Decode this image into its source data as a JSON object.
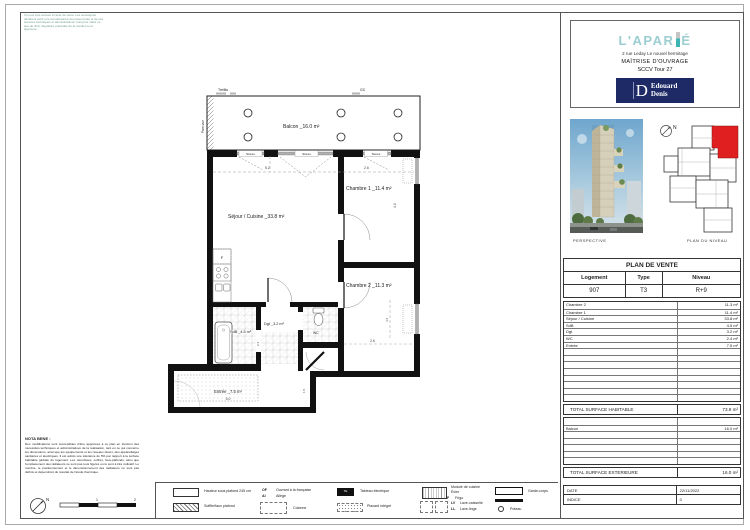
{
  "stamp": {
    "text": "Vu pour être annexé à l'acte de vente. Les soussignés déclarent avoir pris connaissance du présent plan et de ses annexes techniques et administratives. Fait pour valoir ce que de droit. Signature précédée de la mention lu et approuvé."
  },
  "header": {
    "logo_main": "L'APAR",
    "logo_suffix": "É",
    "address": "2 rue Leday Le nouvel hermitage",
    "moa": "MAÎTRISE D'OUVRAGE",
    "sccv": "SCCV Tour 27",
    "builder_initial": "D",
    "builder_line1": "Edouard",
    "builder_line2": "Denis"
  },
  "views": {
    "perspective_label": "PERSPECTIVE",
    "plan_niveau_label": "PLAN DU NIVEAU",
    "north": "N"
  },
  "plan": {
    "treillis": "Treillis",
    "gc": "GC",
    "pare_vue": "Pare-vue",
    "stores": "Stores",
    "balcon": "Balcon _16.0 m²",
    "sejour": "Séjour / Cuisine _33.8 m²",
    "chambre1": "Chambre 1 _11.4 m²",
    "chambre2": "Chambre 2 _11.3 m²",
    "sdb": "SdB _4.5 m²",
    "dgt": "Dgt _3.2 m²",
    "wc": "WC",
    "entree": "Entrée _7.5 m²",
    "f_label": "F",
    "dims": {
      "w_sejour": "5.2",
      "w_ch1": "2.6",
      "h_ch1": "4.0",
      "w_ch2": "2.6",
      "h_ch2": "4.6",
      "w_entree": "5.0",
      "h_entree": "1.5",
      "h_dgt": "2.4"
    }
  },
  "table": {
    "title": "PLAN DE VENTE",
    "col_logement": "Logement",
    "col_type": "Type",
    "col_niveau": "Niveau",
    "logement": "907",
    "type": "T3",
    "niveau": "R+9",
    "rooms": [
      {
        "name": "Chambre 2",
        "area": "11.3 m²"
      },
      {
        "name": "Chambre 1",
        "area": "11.4 m²"
      },
      {
        "name": "Séjour / Cuisine",
        "area": "33.8 m²"
      },
      {
        "name": "SdB",
        "area": "4.5 m²"
      },
      {
        "name": "Dgt",
        "area": "3.2 m²"
      },
      {
        "name": "WC",
        "area": "2.4 m²"
      },
      {
        "name": "Entrée",
        "area": "7.5 m²"
      }
    ],
    "total_hab_label": "TOTAL SURFACE HABITABLE",
    "total_hab": "73.9 m²",
    "balcon_name": "Balcon",
    "balcon_area": "16.0 m²",
    "total_ext_label": "TOTAL SURFACE EXTERIEURE",
    "total_ext": "16.0 m²",
    "date_label": "DATE",
    "date": "22/11/2022",
    "indice_label": "INDICE",
    "indice": "0"
  },
  "legend": {
    "hsp": "Hauteur sous plafond 245 cm",
    "soffite": "Soffite/faux plafond",
    "of_abbr": "OF",
    "of": "Ouvrant à la française",
    "al_abbr": "Al",
    "al": "Allège",
    "colonne": "Colonne",
    "te_abbr": "TE",
    "te": "Tableau électrique",
    "placard": "Placard intégré",
    "module": "Module de cuisine",
    "evier": "Évier",
    "f_abbr": "F",
    "frigo": "Frigo",
    "lv_abbr": "LV",
    "lv": "Lave-vaisselle",
    "ll_abbr": "LL",
    "ll": "Lave-linge",
    "gardecorps": "Garde-corps",
    "poteau": "Poteau"
  },
  "nota": {
    "title": "NOTA BENE :",
    "text": "Des modifications sont susceptibles d'être apportées à ce plan en fonction des nécessités techniques et administratives de la réalisation, tant en ce qui concerne les dimensions, ainsi que les équipements et les réseaux divers, des appareillages sanitaires et électriques. Il est admis une tolérance de 5% par rapport à la surface habitable globale du logement. Les retombées, coffres, faux-plafonds, ainsi que l'emplacement des radiateurs ne sont pas tous figurés ou le sont à titre indicatif. Le nombre, le positionnement et le dimensionnement des radiateurs ne sont pas définis et dépendront du résultat de l'étude thermique."
  },
  "scale": {
    "t1": "1",
    "t2": "2"
  }
}
